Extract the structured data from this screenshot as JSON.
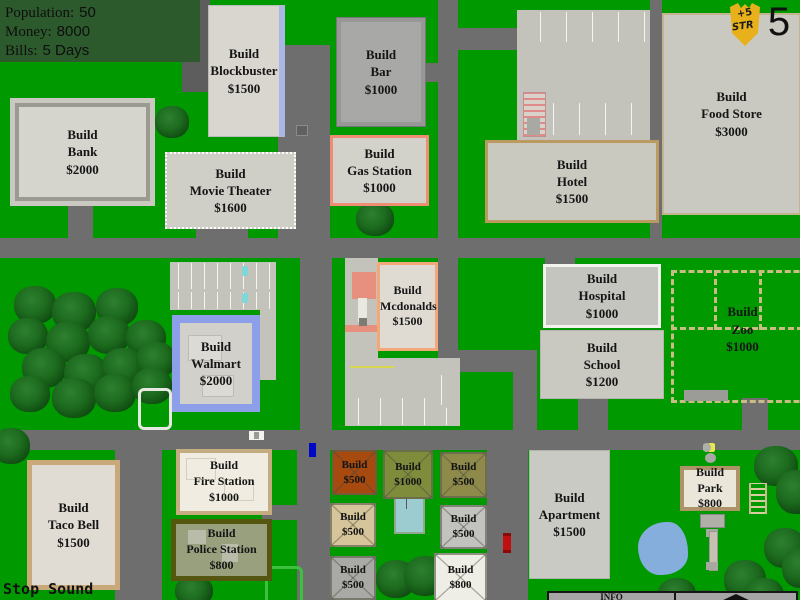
{
  "hud": {
    "population_label": "Population:",
    "population_value": "50",
    "money_label": "Money:",
    "money_value": "8000",
    "bills_label": "Bills:",
    "bills_value": "5 Days"
  },
  "badge": {
    "bonus_line1": "+5",
    "bonus_line2": "STR",
    "day_number": "5"
  },
  "plots": {
    "blockbuster": {
      "l1": "Build",
      "l2": "Blockbuster",
      "l3": "$1500"
    },
    "bar": {
      "l1": "Build",
      "l2": "Bar",
      "l3": "$1000"
    },
    "food_store": {
      "l1": "Build",
      "l2": "Food Store",
      "l3": "$3000"
    },
    "bank": {
      "l1": "Build",
      "l2": "Bank",
      "l3": "$2000"
    },
    "hotel": {
      "l1": "Build",
      "l2": "Hotel",
      "l3": "$1500"
    },
    "gas_station": {
      "l1": "Build",
      "l2": "Gas Station",
      "l3": "$1000"
    },
    "movie_theater": {
      "l1": "Build",
      "l2": "Movie Theater",
      "l3": "$1600"
    },
    "mcdonalds": {
      "l1": "Build",
      "l2": "Mcdonalds",
      "l3": "$1500"
    },
    "hospital": {
      "l1": "Build",
      "l2": "Hospital",
      "l3": "$1000"
    },
    "school": {
      "l1": "Build",
      "l2": "School",
      "l3": "$1200"
    },
    "zoo": {
      "l1": "Build",
      "l2": "Zoo",
      "l3": "$1000"
    },
    "walmart": {
      "l1": "Build",
      "l2": "Walmart",
      "l3": "$2000"
    },
    "taco_bell": {
      "l1": "Build",
      "l2": "Taco Bell",
      "l3": "$1500"
    },
    "fire_station": {
      "l1": "Build",
      "l2": "Fire Station",
      "l3": "$1000"
    },
    "police_station": {
      "l1": "Build",
      "l2": "Police Station",
      "l3": "$800"
    },
    "apartment": {
      "l1": "Build",
      "l2": "Apartment",
      "l3": "$1500"
    },
    "park": {
      "l1": "Build",
      "l2": "Park",
      "l3": "$800"
    },
    "lot_red": {
      "l1": "Build",
      "l2": "$500"
    },
    "lot_olive": {
      "l1": "Build",
      "l2": "$1000"
    },
    "lot_khaki": {
      "l1": "Build",
      "l2": "$500"
    },
    "lot_tan": {
      "l1": "Build",
      "l2": "$500"
    },
    "lot_gray_right": {
      "l1": "Build",
      "l2": "$500"
    },
    "lot_gray_left": {
      "l1": "Build",
      "l2": "$500"
    },
    "lot_white": {
      "l1": "Build",
      "l2": "$800"
    }
  },
  "controls": {
    "stop_sound_label": "Stop Sound",
    "info_label": "INFO"
  },
  "colors": {
    "grass": "#009900",
    "road": "#6E6E6E",
    "hud_bg": "#2C5A2C",
    "badge_gold": "#E8B11C",
    "pond_blue": "#85AEDC",
    "mcdonalds_border": "#F2A878"
  }
}
